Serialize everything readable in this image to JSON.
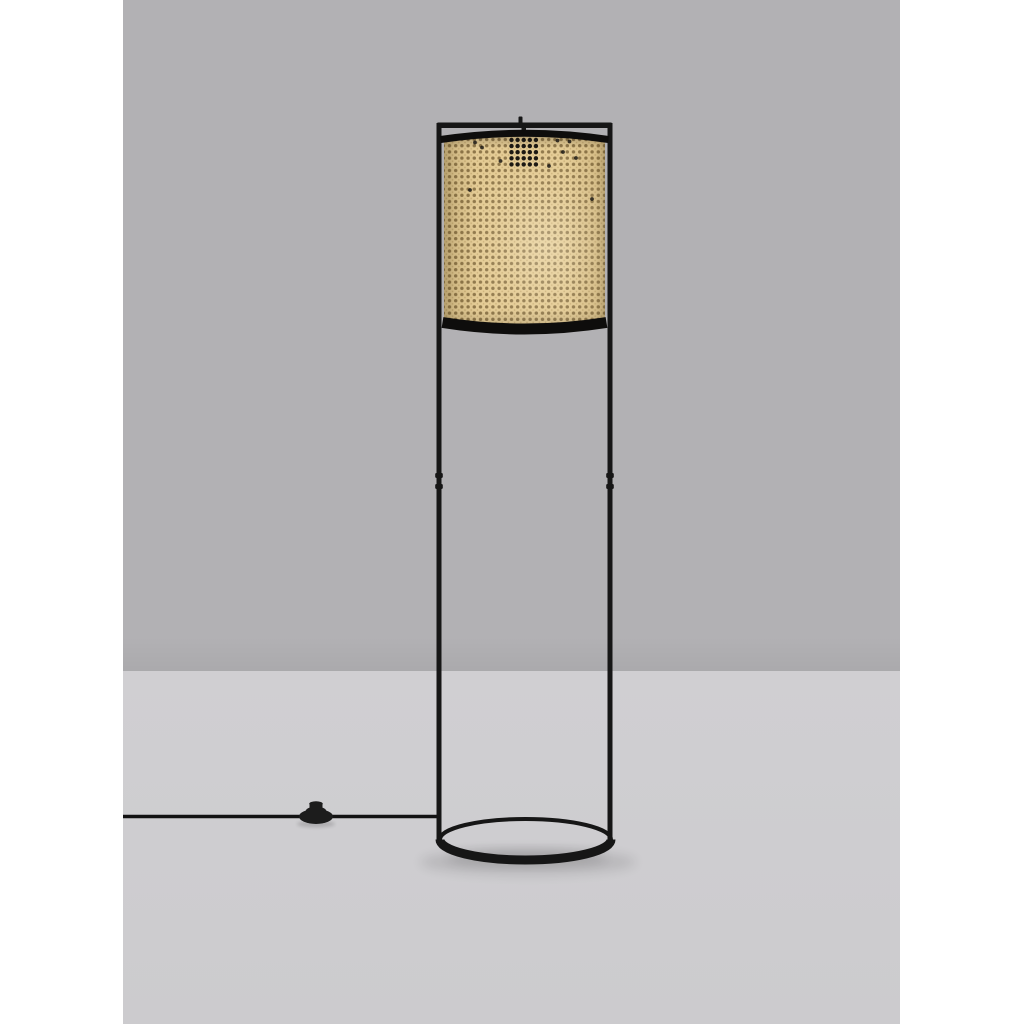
{
  "meta": {
    "kind": "product-photo",
    "subject": "Floor lamp with rattan cane-webbing cylinder shade suspended in a tall thin black metal frame with an oval ring base; black power cord with inline foot switch running across the floor to the left; gray studio wall and lighter gray floor; white margins at left and right of the photo."
  },
  "colors": {
    "page_bg": "#ffffff",
    "wall": "#b2b1b4",
    "floor": "#d0cfd2",
    "floor_bottom": "#cccbce",
    "frame": "#161616",
    "rim": "#0e0d0c",
    "shade_base": "#e4cb94",
    "shade_hole": "#8f774a",
    "shade_microdot": "#c9ae76",
    "cord": "#121212",
    "switch": "#1c1c1c"
  },
  "shade_texture": {
    "pitch": 6.2,
    "hole_radius": 1.7,
    "microdot_radius": 0.8,
    "dark_cluster": {
      "x0": 511.5,
      "y0": 140,
      "cols": 5,
      "rows": 5,
      "dx": 6.1,
      "dy": 6.1,
      "radius": 2.2
    },
    "scattered_dark_dots": [
      [
        557.5,
        140.5
      ],
      [
        569.5,
        141.5
      ],
      [
        576,
        158
      ],
      [
        475,
        142.5
      ],
      [
        482,
        147.5
      ],
      [
        549,
        166
      ],
      [
        500.5,
        161
      ],
      [
        592,
        199
      ],
      [
        563,
        152
      ],
      [
        470,
        190
      ]
    ]
  }
}
